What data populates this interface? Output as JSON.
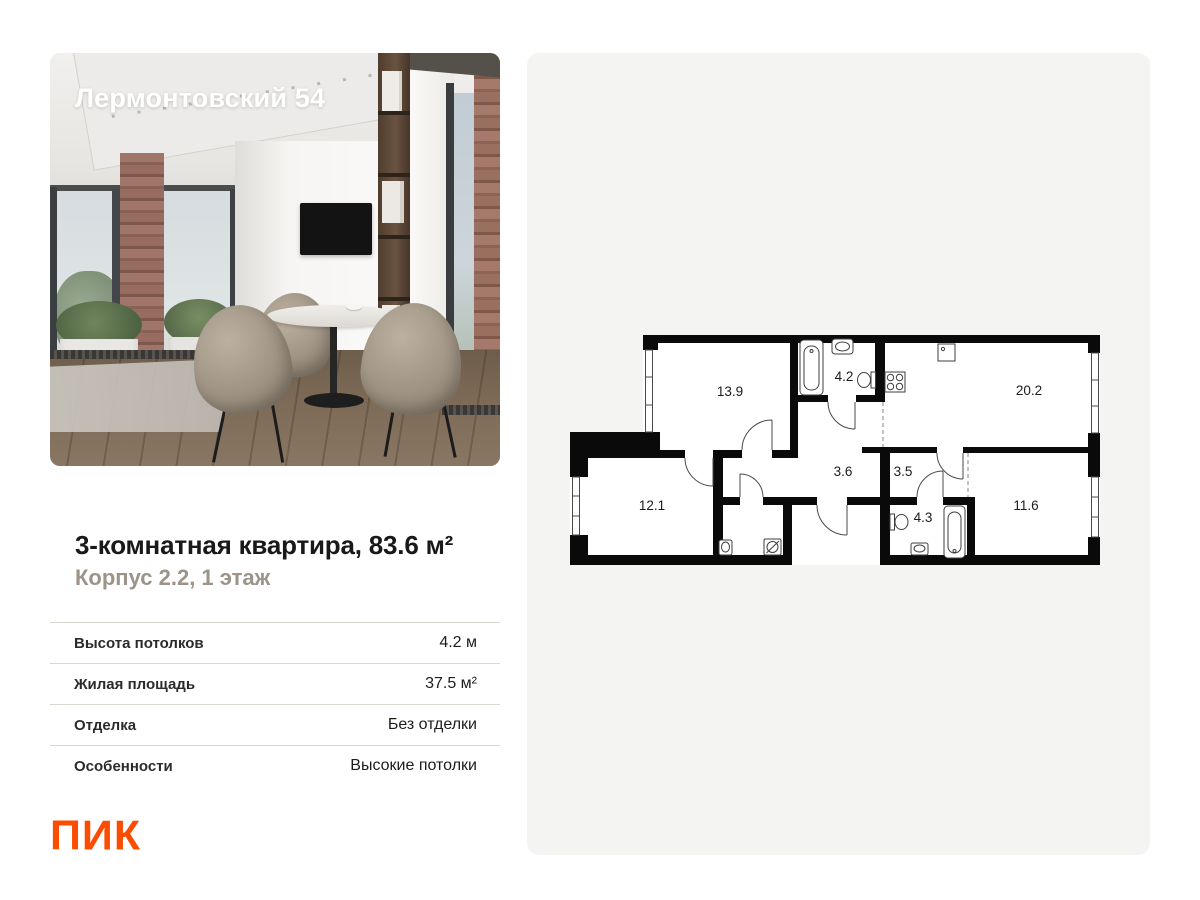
{
  "photo": {
    "overlay_title": "Лермонтовский 54"
  },
  "listing": {
    "title": "3-комнатная квартира, 83.6 м²",
    "subtitle": "Корпус 2.2, 1 этаж",
    "specs": [
      {
        "label": "Высота потолков",
        "value": "4.2 м"
      },
      {
        "label": "Жилая площадь",
        "value": "37.5 м²"
      },
      {
        "label": "Отделка",
        "value": "Без отделки"
      },
      {
        "label": "Особенности",
        "value": "Высокие потолки"
      }
    ]
  },
  "brand": {
    "logo_text": "ПИК",
    "color": "#FC4C02"
  },
  "floorplan": {
    "areas": {
      "bedroom_top": "13.9",
      "bathroom_top": "4.2",
      "kitchen_living": "20.2",
      "hallway_main": "3.6",
      "hallway_small": "3.5",
      "bedroom_left": "12.1",
      "bathroom_bottom": "4.3",
      "bedroom_right": "11.6"
    }
  }
}
